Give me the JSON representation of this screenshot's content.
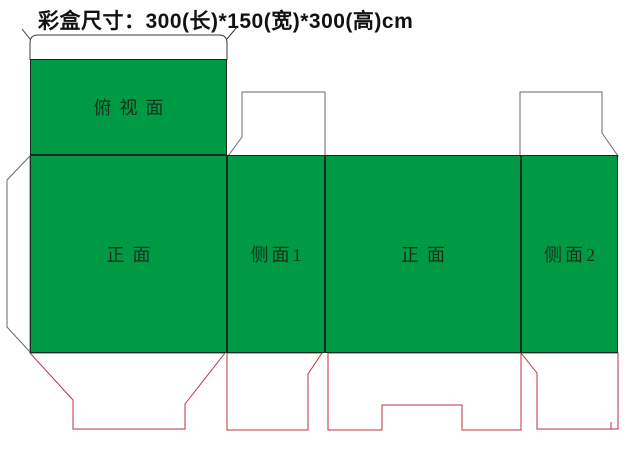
{
  "title": "彩盒尺寸：300(长)*150(宽)*300(高)cm",
  "colors": {
    "panel-green": "#009a44",
    "dieline-red": "#c23240",
    "outline-dark": "#3a3a3a",
    "outline-gray": "#6a6a6a",
    "label-color": "#16301d",
    "title-color": "#121212"
  },
  "panels": {
    "top_view": {
      "label": "俯视面"
    },
    "front_1": {
      "label": "正面"
    },
    "side_1": {
      "label": "侧面1"
    },
    "front_2": {
      "label": "正面"
    },
    "side_2": {
      "label": "侧面2"
    }
  }
}
